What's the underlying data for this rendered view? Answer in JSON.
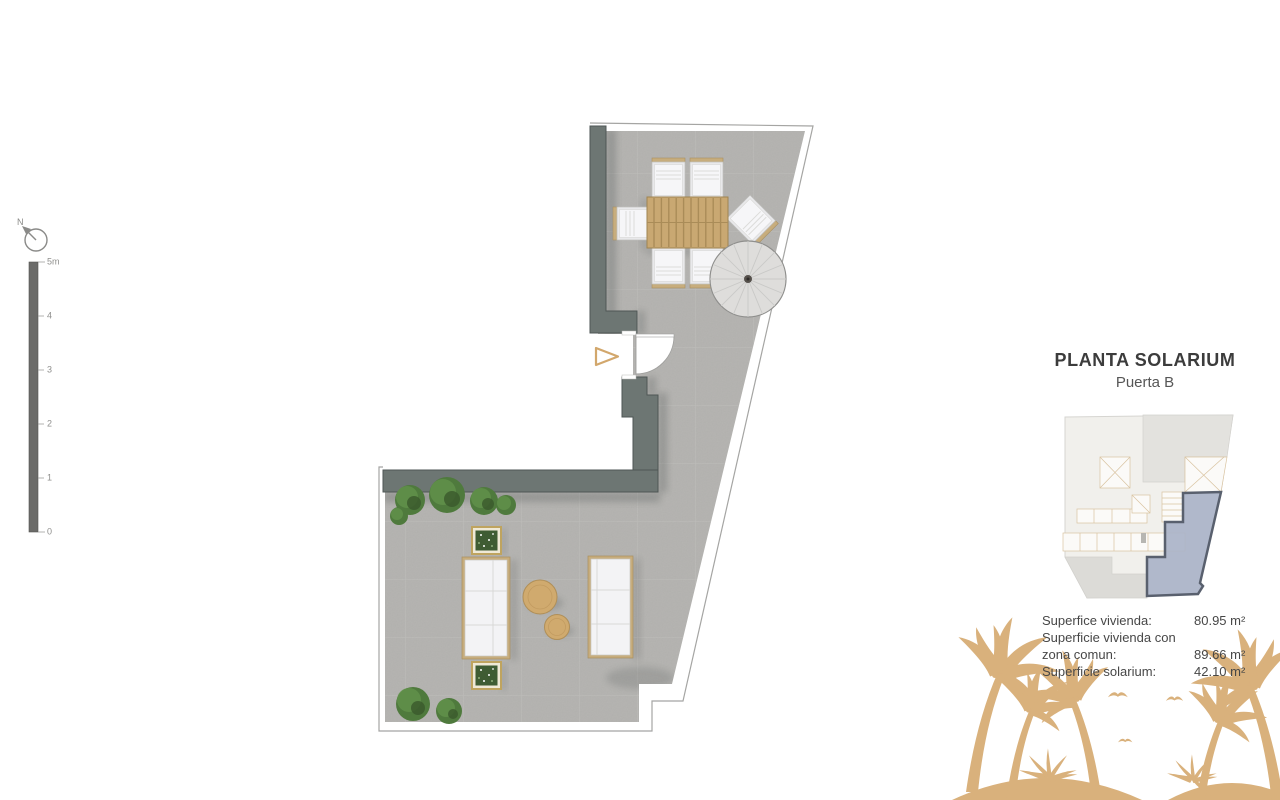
{
  "page": {
    "background": "#ffffff"
  },
  "compass": {
    "label": "N"
  },
  "scale_bar": {
    "ticks": [
      "5m",
      "4",
      "3",
      "2",
      "1",
      "0"
    ]
  },
  "panel": {
    "title": "PLANTA SOLARIUM",
    "subtitle": "Puerta B",
    "surfaces": {
      "rows": [
        {
          "label": "Superfice vivienda:",
          "value": "80.95 m²"
        },
        {
          "label": "Superficie vivienda con zona comun:",
          "value": "89.66 m²"
        },
        {
          "label": "Superficie solarium:",
          "value": "42.10 m²"
        }
      ]
    }
  },
  "colors": {
    "wall": "#6d7673",
    "floor": "#b3b2af",
    "wood": "#c9a872",
    "palm": "#d9b17c",
    "plant": "#4f7a3d",
    "key_highlight": "#aab3c8",
    "key_highlight_outline": "#59606e",
    "title_text": "#3c3c3c"
  }
}
